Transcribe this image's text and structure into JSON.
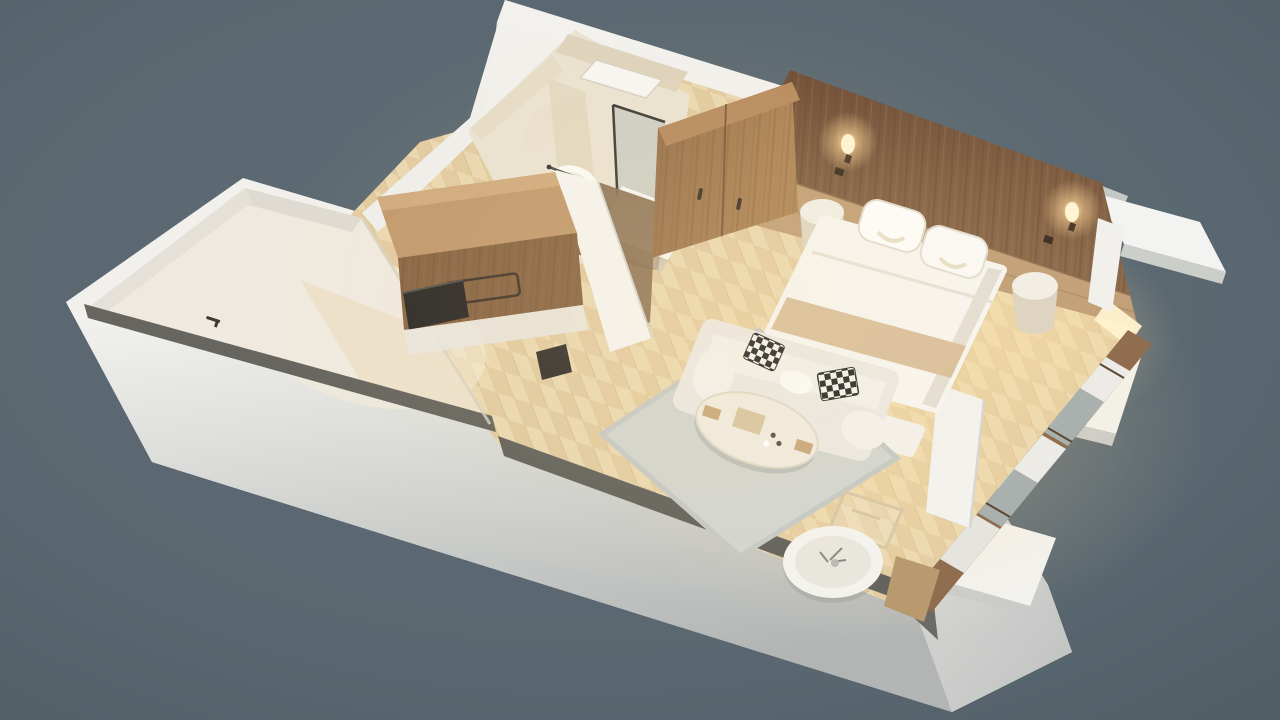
{
  "scene": {
    "title": "Isometric 3D cutaway floor plan of a studio hotel suite on a slate-gray background",
    "type": "3d-floor-plan-render",
    "background_color": "#5c6971",
    "wall_color": "#f2f1ed",
    "floor_style": "light oak herringbone parquet",
    "rooms": [
      {
        "name": "bathroom",
        "furniture": [
          "walk-in shower with white tray",
          "dark framed glass partition",
          "wood vanity counter",
          "round vessel sink with faucet",
          "wall-hung toilet"
        ]
      },
      {
        "name": "entry",
        "furniture": [
          "wooden console with black tray",
          "recessed drawer handle",
          "open white door leaf",
          "white partition wall"
        ]
      },
      {
        "name": "bedroom",
        "furniture": [
          "walnut headboard feature wall",
          "two glowing wall lamps",
          "double bed with white duvet",
          "beige bed runner",
          "two white pillows",
          "round pedestal nightstand left",
          "round pedestal nightstand right",
          "foot bench",
          "wood wardrobe with two handles"
        ]
      },
      {
        "name": "living-area",
        "furniture": [
          "light gray area rug",
          "white sofa",
          "two black-and-white checkered pillows",
          "oval cream coffee table",
          "round white side table with ornament",
          "light wood chair frame"
        ]
      },
      {
        "name": "balcony",
        "furniture": [
          "white terrace floor",
          "dark sliding-door track",
          "small dark door handle"
        ]
      },
      {
        "name": "facade",
        "furniture": [
          "stepped white balcony divider fins",
          "glazed window wall with sheer curtains"
        ]
      }
    ],
    "palette": {
      "background": "#5c6971",
      "wall_white": "#f2f1ed",
      "wall_shadow_gray": "#b8bbba",
      "parquet_light": "#ecdcb8",
      "parquet_mid": "#dfc79c",
      "walnut_dark": "#7a573e",
      "walnut_light": "#8f6a4b",
      "headboard_band": "#c2a078",
      "wardrobe_wood": "#a37a52",
      "counter_wood": "#ab8257",
      "track_dark": "#64635d",
      "rug_gray": "#d3d5d0",
      "sofa_white": "#ebe8e2",
      "bed_white": "#f7f5f0",
      "runner_beige": "#d9c09c",
      "lamp_glow": "#ffd998",
      "cream_floor": "#efe9df"
    },
    "labels": {
      "root": "3D floor plan render of a hotel suite",
      "background": "slate gray backdrop",
      "building": "white cutaway wall shell",
      "balcony": "balcony terrace",
      "bathroom": "bathroom",
      "entry": "entry hall with console",
      "bedroom": "bedroom",
      "living": "living area",
      "windows": "glazed window wall",
      "fins": "white facade fins"
    }
  }
}
